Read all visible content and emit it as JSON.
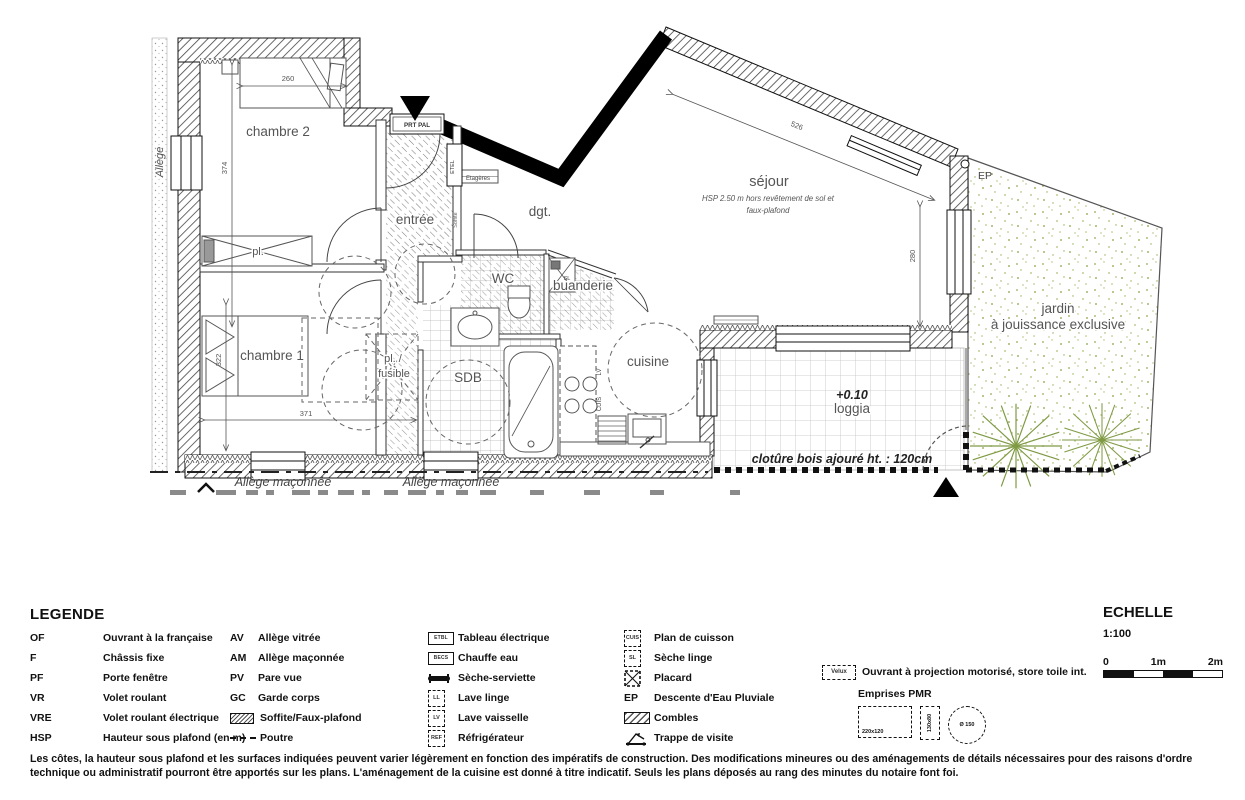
{
  "plan": {
    "rooms": {
      "chambre2": {
        "label": "chambre 2"
      },
      "chambre1": {
        "label": "chambre 1"
      },
      "entree": {
        "label": "entrée"
      },
      "dgt": {
        "label": "dgt."
      },
      "wc": {
        "label": "WC"
      },
      "buanderie": {
        "label": "buanderie"
      },
      "sdb": {
        "label": "SDB"
      },
      "cuisine": {
        "label": "cuisine"
      },
      "sejour": {
        "label": "séjour",
        "hsp1": "HSP 2.50 m hors revêtement de sol et",
        "hsp2": "faux-plafond"
      },
      "loggia": {
        "level": "+0.10",
        "label": "loggia"
      },
      "jardin": {
        "line1": "jardin",
        "line2": "à jouissance exclusive"
      },
      "pl": {
        "label": "pl."
      },
      "pl_fusible": {
        "line1": "pl. /",
        "line2": "fusible"
      }
    },
    "dims": {
      "d260": "260",
      "d374": "374",
      "d322": "322",
      "d371": "371",
      "d526": "526",
      "d280": "280"
    },
    "annotations": {
      "allege": "Allège",
      "prt_pal": "PRT  PAL",
      "etel": "ETEL",
      "etageres": "Etagères",
      "soffite": "Soffite",
      "sl": "SL",
      "lv": "LV",
      "cuis": "CUIS",
      "ep": "EP",
      "cloture": "clotûre bois ajouré ht. : 120cm",
      "allege_maconnee_1": "Allège maçonnée",
      "allege_maconnee_2": "Allège maçonnée"
    }
  },
  "legend": {
    "title": "LEGENDE",
    "columns": [
      {
        "items": [
          {
            "abbr": "OF",
            "label": "Ouvrant à la française"
          },
          {
            "abbr": "F",
            "label": "Châssis fixe"
          },
          {
            "abbr": "PF",
            "label": "Porte fenêtre"
          },
          {
            "abbr": "VR",
            "label": "Volet roulant"
          },
          {
            "abbr": "VRE",
            "label": "Volet roulant électrique"
          },
          {
            "abbr": "HSP",
            "label": "Hauteur sous plafond (en m)"
          }
        ]
      },
      {
        "items": [
          {
            "abbr": "AV",
            "label": "Allège vitrée"
          },
          {
            "abbr": "AM",
            "label": "Allège maçonnée"
          },
          {
            "abbr": "PV",
            "label": "Pare vue"
          },
          {
            "abbr": "GC",
            "label": "Garde corps"
          },
          {
            "icon": "soffite",
            "label": "Soffite/Faux-plafond"
          },
          {
            "icon": "poutre",
            "label": "Poutre"
          }
        ]
      },
      {
        "items": [
          {
            "icon": "box",
            "icon_label": "ETBL",
            "label": "Tableau électrique"
          },
          {
            "icon": "box",
            "icon_label": "BECS",
            "label": "Chauffe eau"
          },
          {
            "icon": "bar",
            "label": "Sèche-serviette"
          },
          {
            "icon": "dashbox",
            "icon_label": "LL",
            "label": "Lave linge"
          },
          {
            "icon": "dashbox",
            "icon_label": "LV",
            "label": "Lave vaisselle"
          },
          {
            "icon": "dashbox",
            "icon_label": "REF",
            "label": "Réfrigérateur"
          }
        ]
      },
      {
        "items": [
          {
            "icon": "dashbox",
            "icon_label": "CUIS",
            "label": "Plan de cuisson"
          },
          {
            "icon": "dashbox",
            "icon_label": "SL",
            "label": "Sèche linge"
          },
          {
            "icon": "placard",
            "label": "Placard"
          },
          {
            "abbr": "EP",
            "label": "Descente d'Eau Pluviale"
          },
          {
            "icon": "combles",
            "label": "Combles"
          },
          {
            "icon": "trappe",
            "label": "Trappe de visite"
          }
        ]
      },
      {
        "items": [
          {
            "icon": "velux",
            "icon_label": "Velux",
            "label": "Ouvrant à projection motorisé, store toile int."
          }
        ]
      }
    ],
    "pmr": {
      "title": "Emprises PMR",
      "rect1": "220x120",
      "rect2": "130x80",
      "circle": "Ø 150"
    }
  },
  "echelle": {
    "title": "ECHELLE",
    "ratio": "1:100",
    "ticks": [
      "0",
      "1m",
      "2m"
    ]
  },
  "footer": {
    "line1": "Les côtes, la hauteur sous plafond et les surfaces indiquées peuvent varier légèrement en fonction des impératifs de construction. Des modifications mineures ou des aménagements de détails nécessaires pour des raisons d'ordre",
    "line2": "technique ou administratif pourront être apportés sur les plans. L'aménagement de la cuisine est donné à titre indicatif. Seuls les plans déposés au rang des minutes du notaire font foi."
  },
  "colors": {
    "ink": "#111111",
    "room_label": "#555555",
    "garden_green": "#93ab52",
    "plant_green": "#7f9a43"
  }
}
